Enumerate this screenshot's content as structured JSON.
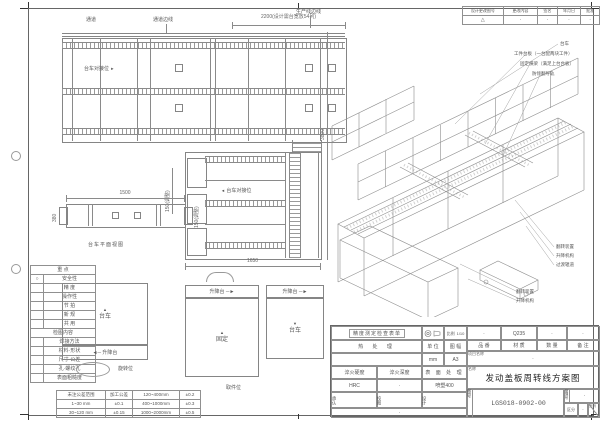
{
  "revision_table": {
    "headers": [
      "设计更改图号",
      "更改内容",
      "签名",
      "年月日",
      "批准"
    ],
    "row": [
      "△",
      "·",
      "·",
      "·",
      "·"
    ]
  },
  "plan_view": {
    "label_aisle": "通道",
    "label_aisle_edge": "通道边线",
    "label_line_edge": "生产线边线",
    "label_dock": "台车对接位",
    "dim_top": "2200(设计需台宽放54列)",
    "dim_height": "3800"
  },
  "center_view": {
    "label_dock": "台车对接位",
    "dim_width": "1650",
    "dim_adjust": "150(调整)"
  },
  "side_view": {
    "dim_length": "1500",
    "dim_width": "380",
    "dim_adjust": "150(调整)",
    "caption": "台车平面视图"
  },
  "iso_view": {
    "callouts": [
      "台车",
      "工件台板（一台配两块工件）",
      "固定横梁（满足上台台板）",
      "防倾翻导轨",
      "翻转装置",
      "升降机构",
      "过渡辊道",
      "翻转装置",
      "升降机构"
    ]
  },
  "checklist": {
    "title": "重 点",
    "items": [
      {
        "mark": "○",
        "label": "安全性"
      },
      {
        "mark": "",
        "label": "精 度"
      },
      {
        "mark": "",
        "label": "操作性"
      },
      {
        "mark": "",
        "label": "节 拍"
      },
      {
        "mark": "",
        "label": "新 规"
      },
      {
        "mark": "",
        "label": "共 用"
      }
    ],
    "section": "检图内容",
    "items2": [
      "焊接方法",
      "材料·形状",
      "尺寸·公差",
      "孔·螺纹孔",
      "表面粗糙度"
    ]
  },
  "tolerance_table": {
    "rows": [
      [
        "未注公差范围",
        "加工公差",
        "120~400mm",
        "±0.2"
      ],
      [
        "1~30 mm",
        "±0.1",
        "400~1000mm",
        "±0.3"
      ],
      [
        "30~120 mm",
        "±0.15",
        "1000~2000mm",
        "±0.5"
      ]
    ]
  },
  "schematic": {
    "cart": "台车",
    "lift": "升降台",
    "fixed": "固定",
    "rotate_pos": "旋转位",
    "pick_pos": "取件位",
    "arrow_up": "▲",
    "arrow_down": "▼",
    "strip_left": "◄─ 升降台",
    "strip_right": "升降台 ─►"
  },
  "title_block": {
    "inspect_header": "精度测定检查表单",
    "scale_label": "比例",
    "scale_value": "1/10",
    "heat_label": "热 处 理",
    "unit_label": "单 位",
    "format_label": "图 幅",
    "unit_value": "mm",
    "format_value": "A3",
    "hardness_label": "淬火硬度",
    "depth_label": "淬火深度",
    "surface_label": "表 面 处 理",
    "hardness_value": "HRC",
    "depth_value": "·",
    "surface_value": "喷塑400",
    "approve_label": "承认",
    "check_label": "校图",
    "design_label": "设计",
    "note_row": "·",
    "part_headers": [
      "品 番",
      "材 质",
      "数 量",
      "备 注"
    ],
    "part_values": [
      "·",
      "Q235",
      "·",
      "·"
    ],
    "project_label": "项目名称",
    "project_value": "·",
    "name_label": "名称",
    "drawing_title": "发动盖板周转线方案图",
    "no_label": "图号",
    "drawing_no": "LGS018-0902-00",
    "mgmt_label": "管理号",
    "mgmt_value": "·",
    "class_label": "区分",
    "class_value": "·",
    "page_label": "页码"
  }
}
